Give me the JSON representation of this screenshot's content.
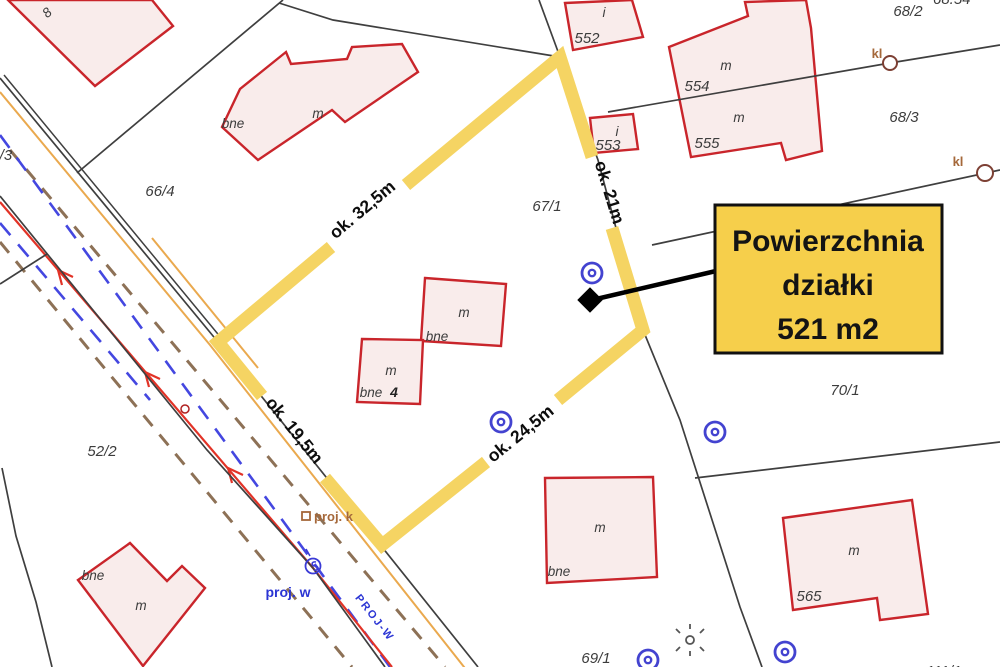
{
  "colors": {
    "highlight_yellow": "#f5d463",
    "callout_yellow": "#f6cf4b",
    "building_fill": "#f9eceb",
    "building_stroke": "#c9252b",
    "boundary_gray": "#3f3f3f",
    "road_red": "#e23327",
    "road_orange": "#eaa94e",
    "dash_brown": "#8d7156",
    "dash_blue": "#4447e0",
    "utility_blue": "#4343d0",
    "kl_brown": "#a5683a",
    "proj_blue": "#2b35d4",
    "label_gray": "#3c3c3c"
  },
  "callout": {
    "line1": "Powierzchnia",
    "line2": "działki",
    "line3": "521 m2"
  },
  "dimensions": {
    "top_left_edge": "ok. 32,5m",
    "right_edge": "ok. 21m",
    "bottom_left_edge": "ok. 19,5m",
    "bottom_right_edge": "ok. 24,5m"
  },
  "parcel_numbers": {
    "p66_4": "66/4",
    "p67_1": "67/1",
    "p68_2": "68/2",
    "p68_3": "68/3",
    "p70_1": "70/1",
    "p69_1": "69/1",
    "p52_2": "52/2"
  },
  "building_numbers": {
    "b552": "552",
    "b553": "553",
    "b554": "554",
    "b555": "555",
    "b565": "565",
    "b8": "8",
    "b4": "4"
  },
  "building_labels": {
    "m": "m",
    "bne": "bne",
    "i": "i"
  },
  "road_labels": {
    "proj_k": "proj. k",
    "proj_w": "proj. w",
    "proj_w_axis": "PROJ-W"
  },
  "utility_labels": {
    "kl": "kl"
  },
  "partial_labels": {
    "top_right": "68.54",
    "left_edge": "52/3",
    "bottom_right": "111/1"
  }
}
